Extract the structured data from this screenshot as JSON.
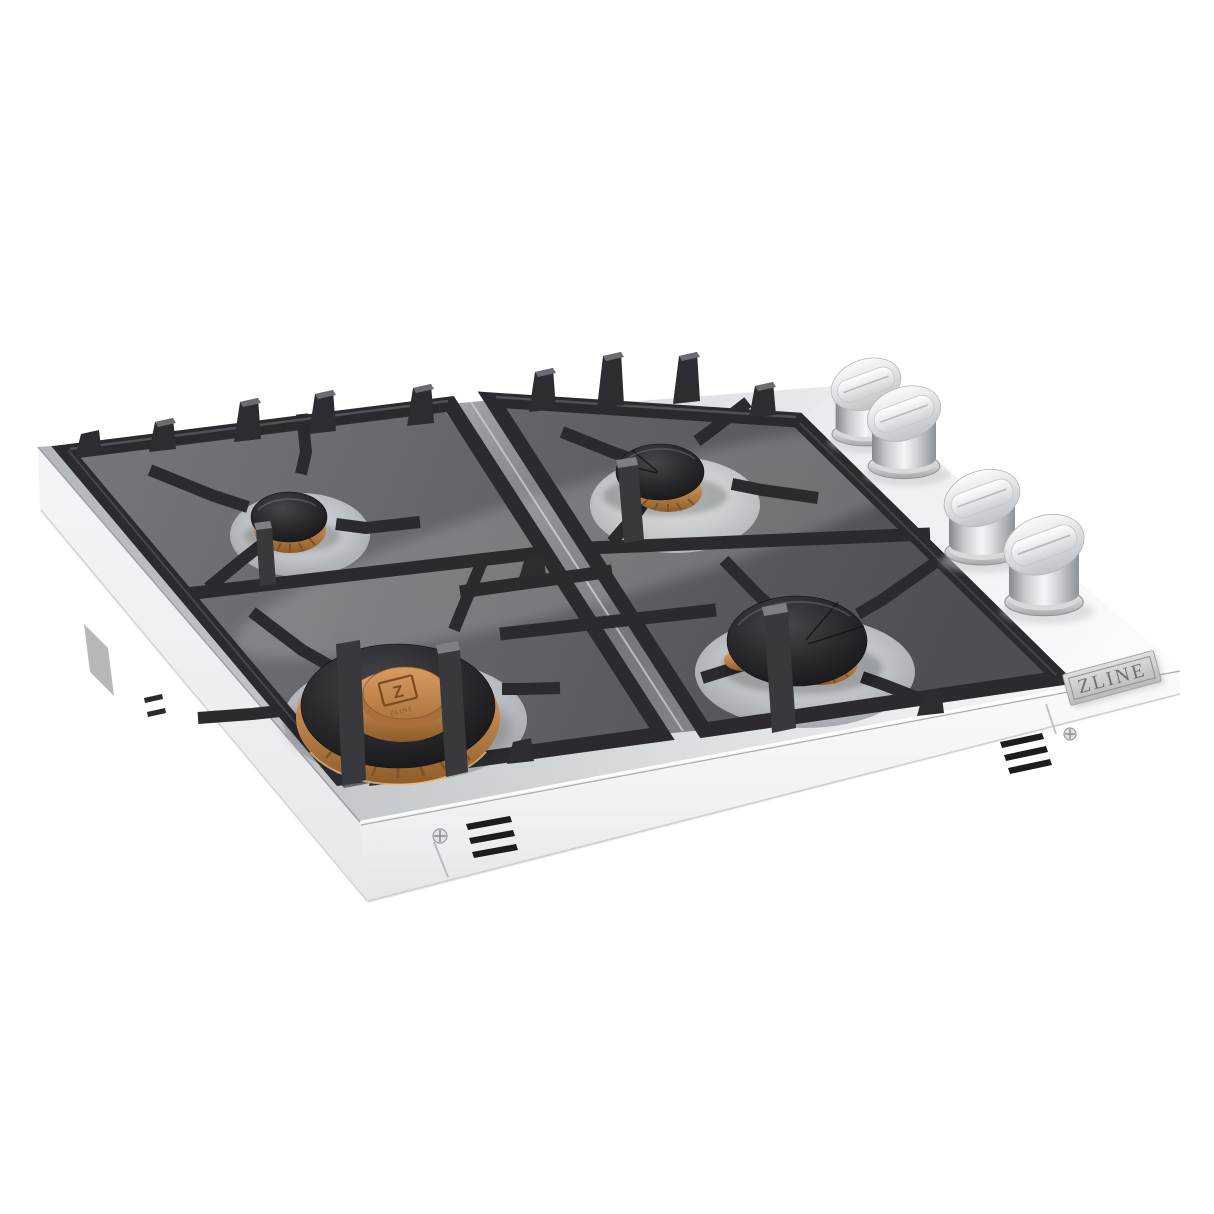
{
  "scene": {
    "kind": "product-photo",
    "subject": "Stainless steel 4-burner drop-in gas cooktop with black cast-iron grates, brass burners and stainless control knobs, three-quarter angled view on seamless white background",
    "background_color": "#ffffff"
  },
  "brand": {
    "badge_text": "ZLINE",
    "burner_monogram": "Z",
    "burner_monogram_caption": "ZLINE"
  },
  "colors": {
    "stainless_bright": "#f6f7f8",
    "stainless_mid": "#c9ccd0",
    "stainless_shadow": "#9ba0a5",
    "grate_iron": "#2b2b2f",
    "grate_highlight": "#5d5e63",
    "burner_cap_black": "#1d1d20",
    "brass": "#c18a52",
    "brass_deep": "#8f5c2a",
    "badge_plate": "#cfd1d4",
    "badge_text_color": "#6e7073"
  },
  "components": {
    "grate_sections": 2,
    "burners": [
      {
        "id": "back-left",
        "size": "small",
        "cap": "black",
        "ring": "brass"
      },
      {
        "id": "back-right",
        "size": "medium",
        "cap": "black",
        "ring": "brass"
      },
      {
        "id": "front-left",
        "size": "large",
        "cap": "brass with Z monogram",
        "ring": "brass dual-ring"
      },
      {
        "id": "front-right",
        "size": "large",
        "cap": "black",
        "ring": "brass"
      }
    ],
    "knobs": {
      "count": 4,
      "finish": "brushed stainless",
      "layout": "diagonal row, right side"
    },
    "vents": {
      "front_left_slats": 3,
      "front_right_slats": 3,
      "left_side_slits": 2
    },
    "screws": {
      "count": 2,
      "type": "phillips"
    }
  }
}
